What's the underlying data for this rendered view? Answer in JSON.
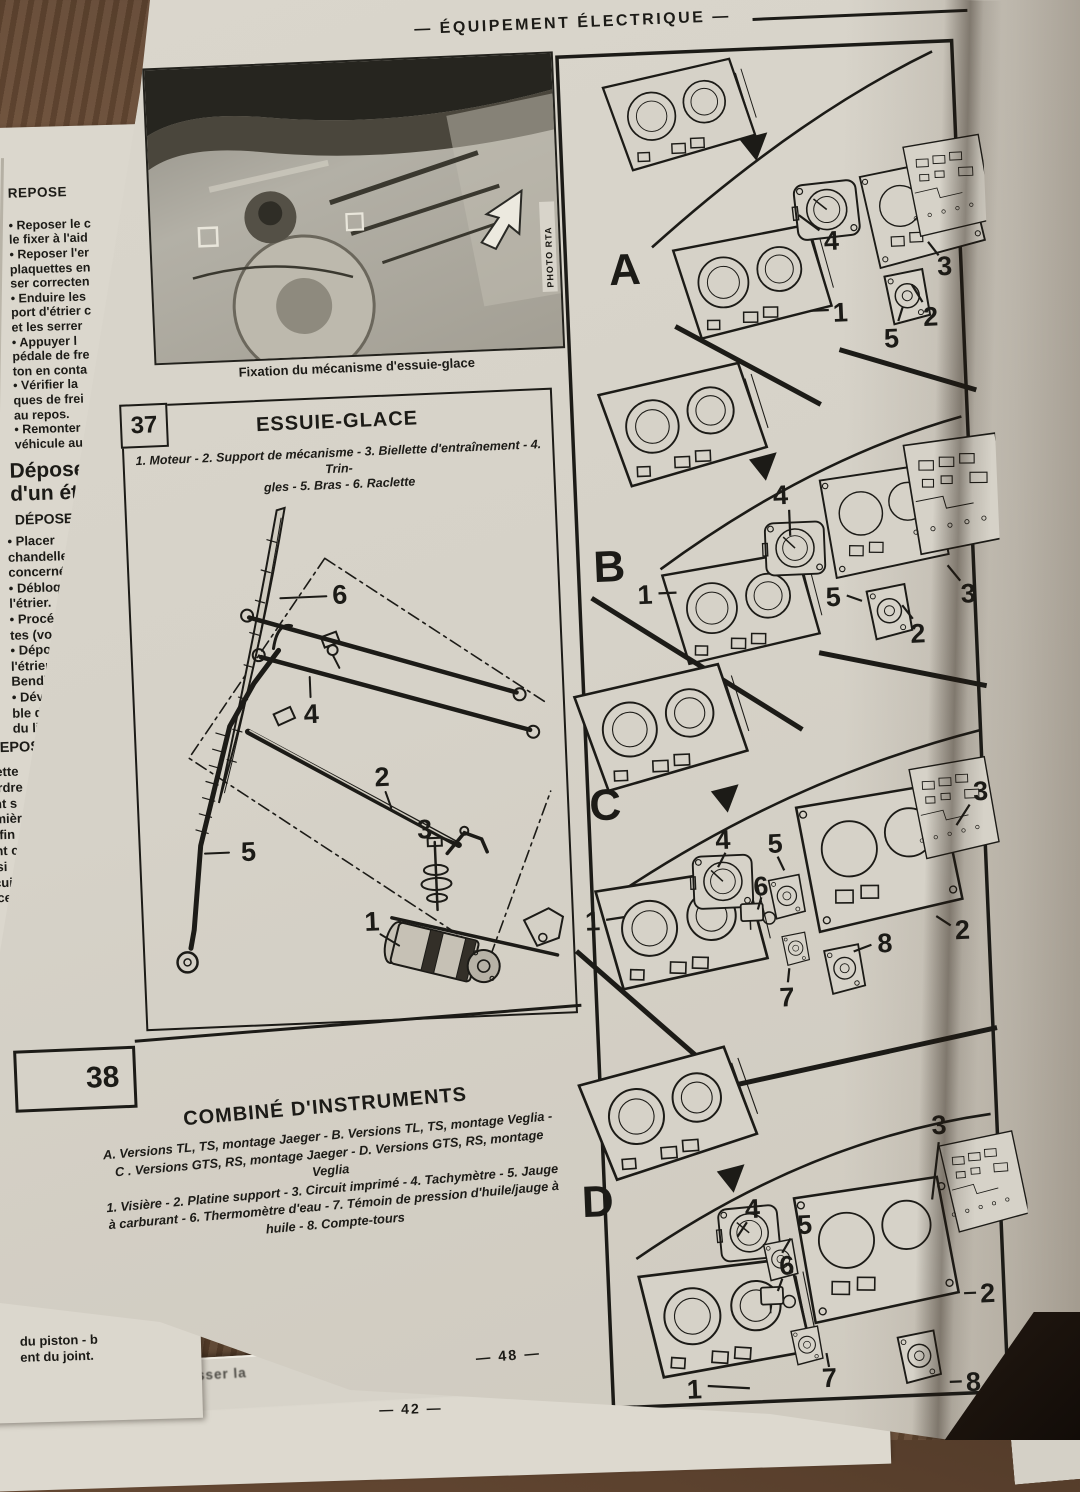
{
  "header": {
    "title": "— ÉQUIPEMENT ÉLECTRIQUE —"
  },
  "photo": {
    "caption": "Fixation du mécanisme d'essuie-glace",
    "credit": "PHOTO RTA"
  },
  "figure37": {
    "number": "37",
    "title": "ESSUIE-GLACE",
    "legend": "1. Moteur - 2. Support de mécanisme - 3. Biellette d'entraînement - 4. Trin-\ngles - 5. Bras - 6. Raclette",
    "labels": [
      "1",
      "2",
      "3",
      "4",
      "5",
      "6"
    ]
  },
  "figure38": {
    "number": "38",
    "title": "COMBINÉ D'INSTRUMENTS",
    "legend_versions": "A. Versions TL, TS, montage Jaeger - B. Versions TL, TS, montage Veglia -\nC . Versions GTS, RS, montage Jaeger - D. Versions GTS, RS, montage Veglia",
    "legend_parts": "1. Visière - 2. Platine support - 3. Circuit imprimé - 4. Tachymètre - 5. Jauge\nà carburant - 6. Thermomètre d'eau - 7. Témoin de pression d'huile/jauge à\nhuile - 8. Compte-tours",
    "sections": [
      {
        "label": "A",
        "parts": {
          "p1": "1",
          "p2": "2",
          "p3": "3",
          "p4": "4",
          "p5": "5"
        }
      },
      {
        "label": "B",
        "parts": {
          "p1": "1",
          "p2": "2",
          "p3": "3",
          "p4": "4",
          "p5": "5"
        }
      },
      {
        "label": "C",
        "parts": {
          "p1": "1",
          "p2": "2",
          "p3": "3",
          "p4": "4",
          "p5": "5",
          "p6": "6",
          "p7": "7",
          "p8": "8"
        }
      },
      {
        "label": "D",
        "parts": {
          "p1": "1",
          "p2": "2",
          "p3": "3",
          "p4": "4",
          "p5": "5",
          "p6": "6",
          "p7": "7",
          "p8": "8"
        }
      }
    ]
  },
  "page_numbers": {
    "current": "— 48 —",
    "underneath": "— 42 —"
  },
  "left_page": {
    "heading1": "REPOSE",
    "block1": "• Reposer le c\nle fixer à l'aid\n• Reposer l'er\nplaquettes en\nser correcten\n• Enduire les\nport d'étrier c\net les serrer\n• Appuyer l\npédale de fre\nton en conta\n• Vérifier la\nques de frei\nau repos.\n• Remonter\nvéhicule au",
    "heading2": "Dépose\nd'un ét",
    "heading3": "DÉPOSE",
    "block2": "• Placer\nchandelles\nconcerné.\n• Débloq\nl'étrier.\n• Procéd\ntes (voir\n• Dépos\nl'étrier s\nBendix).\n• Dévis\nble de l'\ndu liqui",
    "heading4": "REPOS",
    "block3": "Cette\n'ordre\nant s\nemièr\nn fin\nent c\nnsi\nrcui\nnce",
    "bottom_fragment": "du piston - b\nent du joint."
  },
  "right_page": {
    "caption_fragment": "1. V",
    "column": "— L'état\nd'usure, le\nleurs guide\n— La pres\nsorts de b\n— L'état\nsera netto\nd'un chiff\ntrichlorét\npapier de\nde toile\n— L'éta\ntes des\nment, in\npendan\nde l'hui\nde les\n— L'é\ninducte\ndevant\nde brû",
    "heading": "Rég",
    "column2": "Le\n(outr\naire\nrecte"
  },
  "under_fragments": {
    "pousser": "l pousser la"
  }
}
